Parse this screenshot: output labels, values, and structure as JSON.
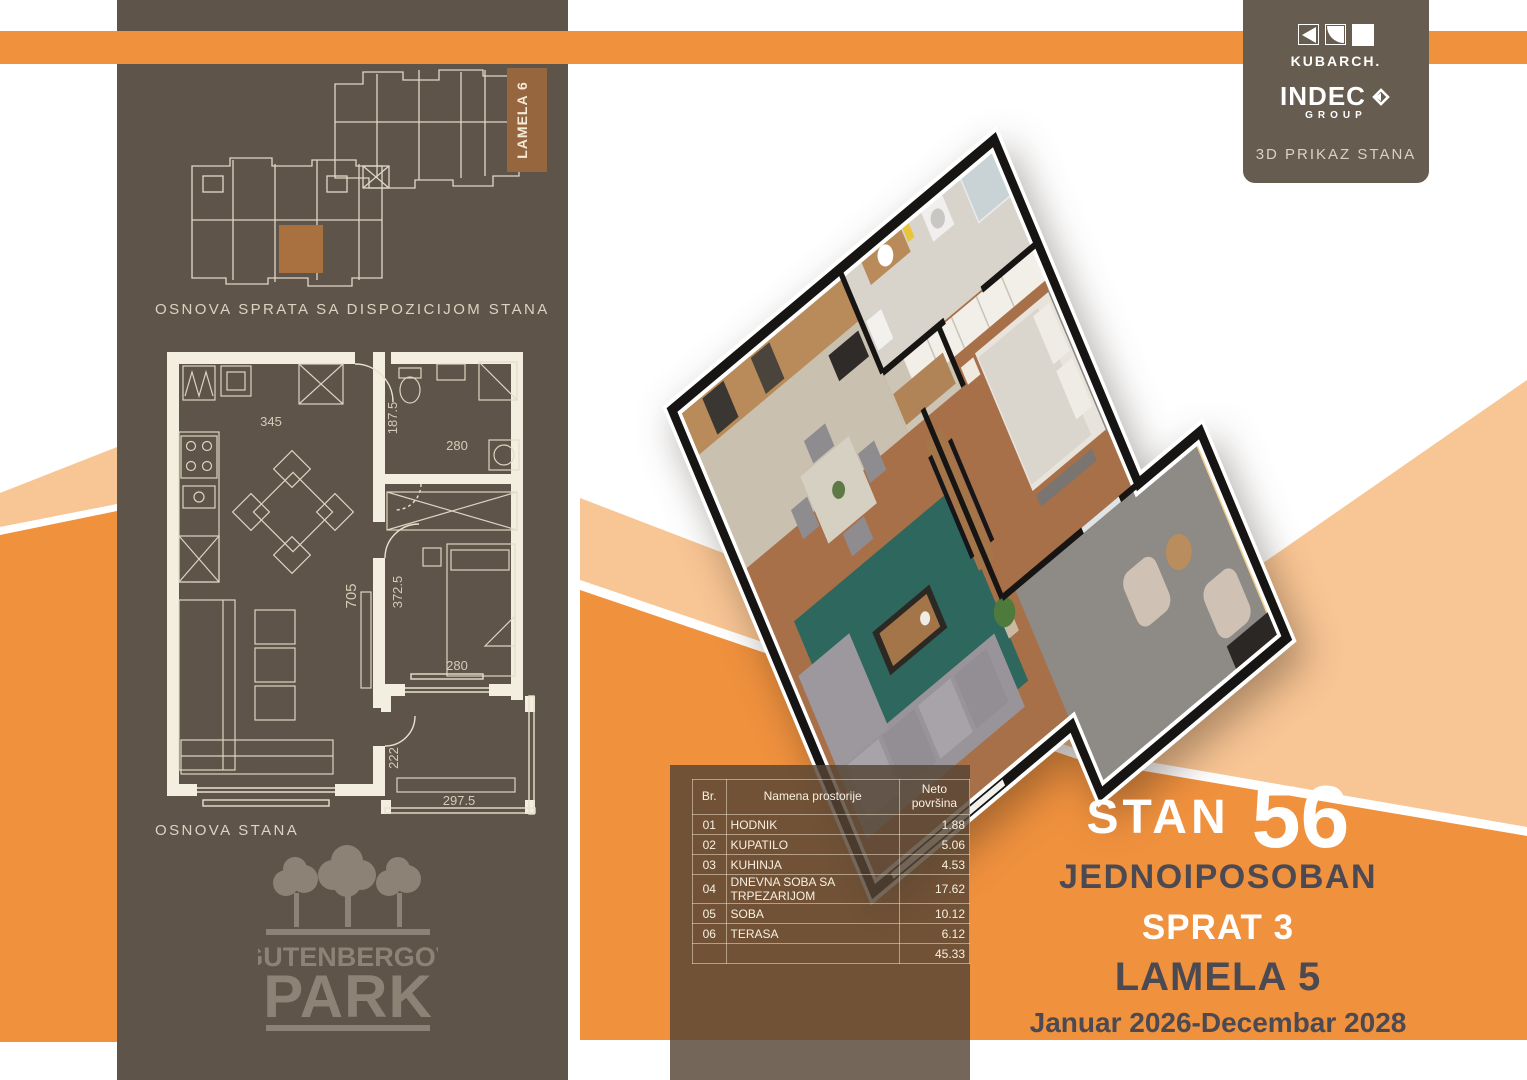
{
  "colors": {
    "orange": "#f0913e",
    "peach": "#f8c594",
    "panel_brown": "#5e5449",
    "accent_brown": "#a9713f",
    "ink": "#4b4a53"
  },
  "header": {
    "kubarch": "KUBARCH.",
    "indec": "INDEC",
    "group": "GROUP",
    "caption": "3D PRIKAZ STANA"
  },
  "left_panel": {
    "caption_building": "OSNOVA SPRATA SA DISPOZICIJOM STANA",
    "caption_unit": "OSNOVA STANA",
    "lamela_tag": "LAMELA 6",
    "brand": {
      "line1": "GUTENBERGOV",
      "line2": "PARK"
    },
    "plan_dims": {
      "kitchen_w": "345",
      "bath_h": "187.5",
      "bath_w": "280",
      "living_h": "705",
      "bed_h": "372.5",
      "bed_w": "280",
      "terrace_h": "222",
      "terrace_w": "297.5"
    }
  },
  "area_table": {
    "headers": {
      "no": "Br.",
      "name": "Namena prostorije",
      "area_line1": "Neto",
      "area_line2": "površina"
    },
    "rows": [
      {
        "no": "01",
        "name": "HODNIK",
        "area": "1.88"
      },
      {
        "no": "02",
        "name": "KUPATILO",
        "area": "5.06"
      },
      {
        "no": "03",
        "name": "KUHINJA",
        "area": "4.53"
      },
      {
        "no": "04",
        "name": "DNEVNA SOBA SA TRPEZARIJOM",
        "area": "17.62"
      },
      {
        "no": "05",
        "name": "SOBA",
        "area": "10.12"
      },
      {
        "no": "06",
        "name": "TERASA",
        "area": "6.12"
      }
    ],
    "total": "45.33"
  },
  "info": {
    "stan_label": "STAN",
    "stan_number": "56",
    "unit_type": "JEDNOIPOSOBAN",
    "floor": "SPRAT 3",
    "lamela": "LAMELA 5",
    "period": "Januar 2026-Decembar 2028"
  }
}
